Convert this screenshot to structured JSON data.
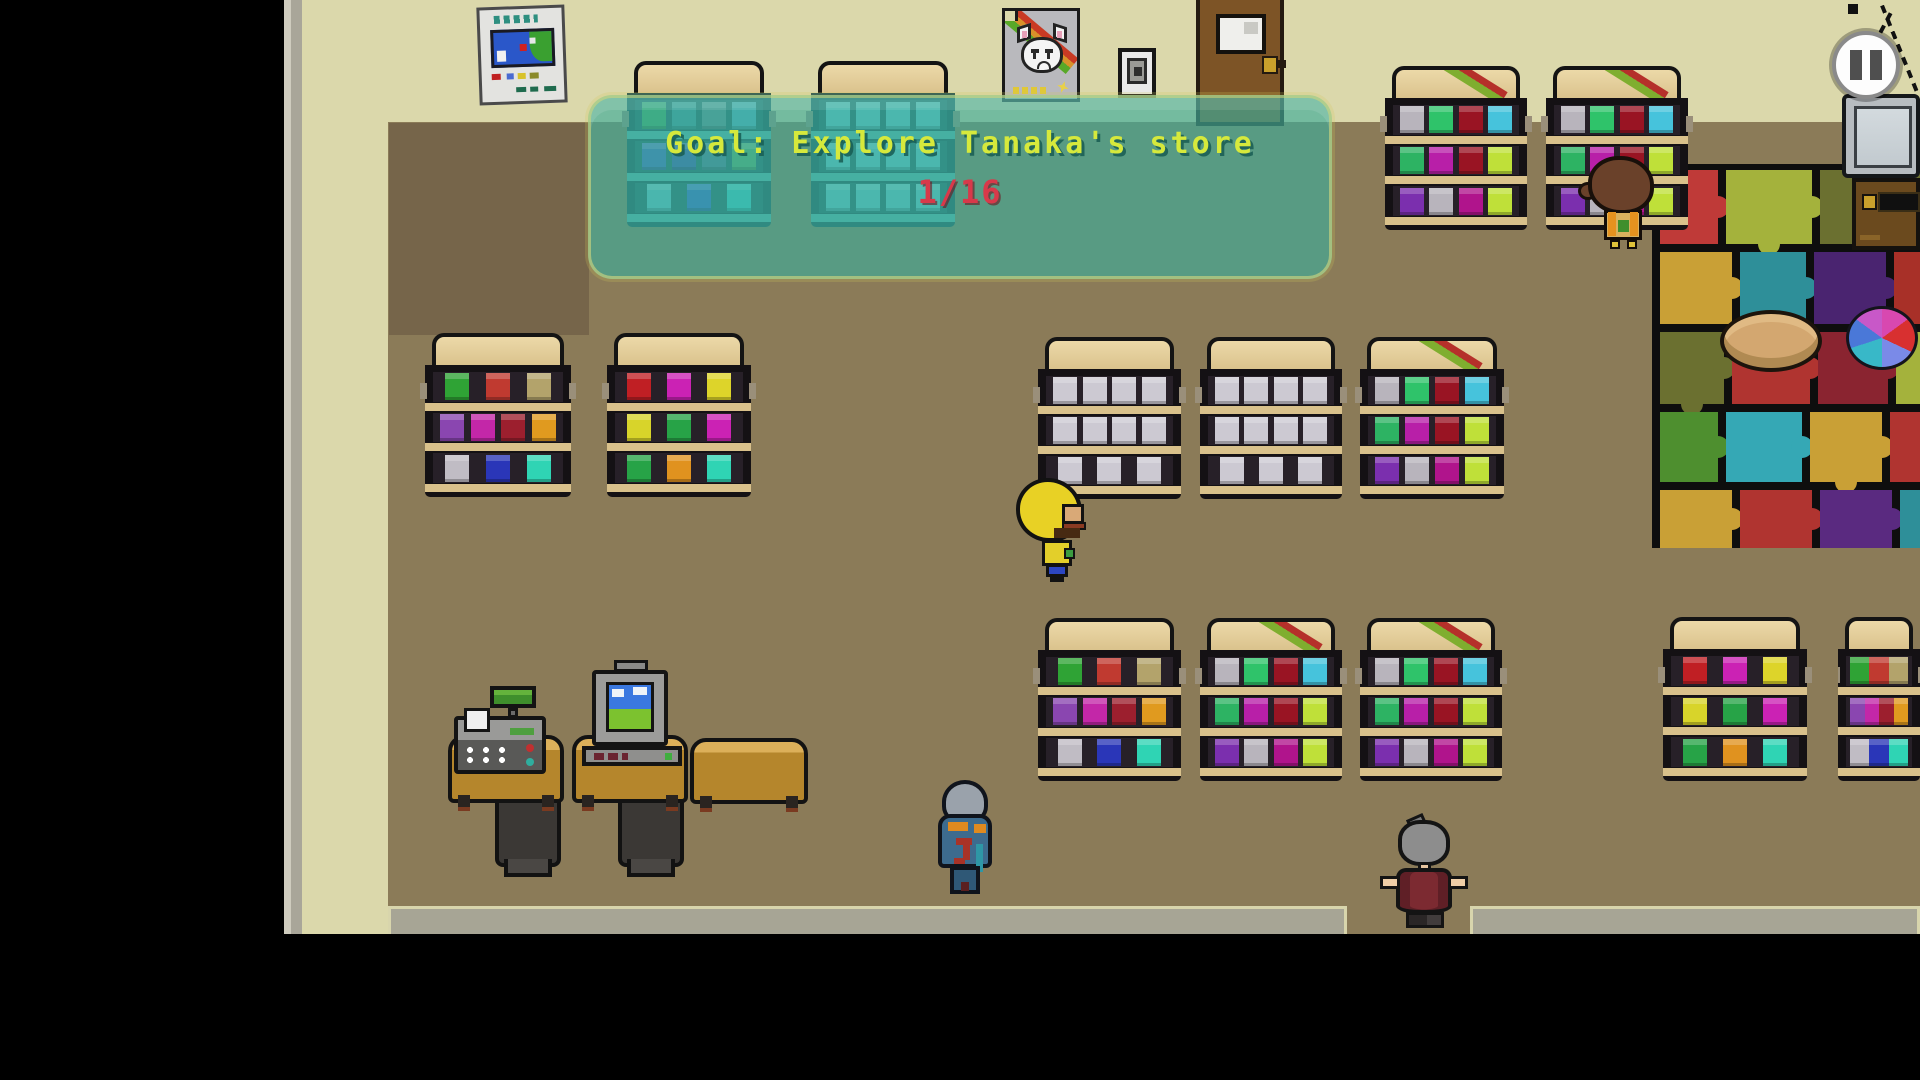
{
  "hud": {
    "goal": {
      "label": "Goal: Explore Tanaka's store",
      "progress": "1/16"
    },
    "pause_icon": "pause-icon"
  },
  "colors": {
    "banner_fill": "rgba(62,172,154,0.66)",
    "goal_text": "#d6e93c",
    "progress_text": "#d8394a",
    "wall": "#dbd8ab",
    "floor": "#8b7b58",
    "mat_base": "#0e0e0e"
  },
  "shelf_variants": {
    "A": {
      "striped": false,
      "tinted": false,
      "rows": [
        [
          "#2fa335",
          "#c03a30",
          "#b3a36b"
        ],
        [
          "#8a46b0",
          "#c327a8",
          "#9c1f2e",
          "#e09a1f"
        ],
        [
          "#c0bcc4",
          "#2a36b8",
          "#2fd4b4"
        ]
      ]
    },
    "B": {
      "striped": false,
      "tinted": false,
      "rows": [
        [
          "#c01f24",
          "#cb22b4",
          "#ddd42a"
        ],
        [
          "#d8d42a",
          "#27a347",
          "#cb22b4"
        ],
        [
          "#27a347",
          "#e0921f",
          "#2fd4b4"
        ]
      ]
    },
    "C": {
      "striped": true,
      "tinted": false,
      "rows": [
        [
          "#b8b4bc",
          "#2fc36a",
          "#991423",
          "#46c3dc"
        ],
        [
          "#2db363",
          "#b81fa8",
          "#991423",
          "#bfe039"
        ],
        [
          "#7b2fae",
          "#b8b4bc",
          "#b0148c",
          "#bfe039"
        ]
      ]
    },
    "D": {
      "striped": false,
      "tinted": false,
      "rows": [
        [
          "#ccc9d2",
          "#ccc9d2",
          "#ccc9d2",
          "#ccc9d2"
        ],
        [
          "#ccc9d2",
          "#ccc9d2",
          "#ccc9d2",
          "#ccc9d2"
        ],
        [
          "#ccc9d2",
          "#ccc9d2",
          "#ccc9d2"
        ]
      ]
    },
    "VEND_A": {
      "striped": false,
      "tinted": true,
      "rows": [
        [
          "#3fae62",
          "#3e99a0",
          "#5d8f96",
          "#4fb3c9"
        ],
        [
          "#3f63c9",
          "#3a51b5",
          "#4a7a99",
          "#57b06b"
        ],
        [
          "#62c9d6",
          "#2f62d9",
          "#35d6d6"
        ]
      ]
    },
    "VEND_B": {
      "striped": false,
      "tinted": true,
      "rows": [
        [
          "#63cdd6",
          "#63cdd6",
          "#63cdd6",
          "#63cdd6"
        ],
        [
          "#63cdd6",
          "#63cdd6",
          "#63cdd6",
          "#63cdd6"
        ],
        [
          "#63cdd6",
          "#63cdd6",
          "#63cdd6",
          "#63cdd6"
        ]
      ]
    }
  },
  "shelves": [
    {
      "x": 627,
      "y": 61,
      "w": 144,
      "h": 166,
      "variant": "VEND_A"
    },
    {
      "x": 811,
      "y": 61,
      "w": 144,
      "h": 166,
      "variant": "VEND_B"
    },
    {
      "x": 1385,
      "y": 66,
      "w": 142,
      "h": 164,
      "variant": "C"
    },
    {
      "x": 1546,
      "y": 66,
      "w": 142,
      "h": 164,
      "variant": "C"
    },
    {
      "x": 425,
      "y": 333,
      "w": 146,
      "h": 164,
      "variant": "A"
    },
    {
      "x": 607,
      "y": 333,
      "w": 144,
      "h": 164,
      "variant": "B"
    },
    {
      "x": 1038,
      "y": 337,
      "w": 143,
      "h": 162,
      "variant": "D"
    },
    {
      "x": 1200,
      "y": 337,
      "w": 142,
      "h": 162,
      "variant": "D"
    },
    {
      "x": 1360,
      "y": 337,
      "w": 144,
      "h": 162,
      "variant": "C"
    },
    {
      "x": 1038,
      "y": 618,
      "w": 143,
      "h": 163,
      "variant": "A"
    },
    {
      "x": 1200,
      "y": 618,
      "w": 142,
      "h": 163,
      "variant": "C"
    },
    {
      "x": 1360,
      "y": 618,
      "w": 142,
      "h": 163,
      "variant": "C"
    },
    {
      "x": 1663,
      "y": 617,
      "w": 144,
      "h": 164,
      "variant": "B"
    },
    {
      "x": 1838,
      "y": 617,
      "w": 82,
      "h": 164,
      "variant": "A",
      "clip": true
    }
  ],
  "mat": {
    "x": 1652,
    "y": 164,
    "w": 268,
    "h": 384,
    "pieces": [
      {
        "x": 8,
        "y": 6,
        "w": 58,
        "h": 74,
        "c": "#bf3a38",
        "tabs": "r"
      },
      {
        "x": 74,
        "y": 6,
        "w": 86,
        "h": 74,
        "c": "#a4b23c",
        "tabs": "rb"
      },
      {
        "x": 168,
        "y": 6,
        "w": 100,
        "h": 74,
        "c": "#6b7030",
        "tabs": ""
      },
      {
        "x": 8,
        "y": 88,
        "w": 72,
        "h": 72,
        "c": "#c9a036",
        "tabs": "r"
      },
      {
        "x": 88,
        "y": 88,
        "w": 66,
        "h": 72,
        "c": "#2e8f99",
        "tabs": "rb"
      },
      {
        "x": 162,
        "y": 88,
        "w": 72,
        "h": 72,
        "c": "#4a2470",
        "tabs": "r"
      },
      {
        "x": 242,
        "y": 88,
        "w": 26,
        "h": 72,
        "c": "#a83028",
        "tabs": ""
      },
      {
        "x": 8,
        "y": 168,
        "w": 64,
        "h": 72,
        "c": "#6b7030",
        "tabs": "rb"
      },
      {
        "x": 80,
        "y": 168,
        "w": 78,
        "h": 72,
        "c": "#b03430",
        "tabs": "r"
      },
      {
        "x": 166,
        "y": 168,
        "w": 70,
        "h": 72,
        "c": "#8a2430",
        "tabs": "r"
      },
      {
        "x": 244,
        "y": 168,
        "w": 24,
        "h": 72,
        "c": "#a4b23c",
        "tabs": ""
      },
      {
        "x": 8,
        "y": 248,
        "w": 58,
        "h": 70,
        "c": "#4e8f2f",
        "tabs": "r"
      },
      {
        "x": 74,
        "y": 248,
        "w": 76,
        "h": 70,
        "c": "#35a8b5",
        "tabs": "r"
      },
      {
        "x": 158,
        "y": 248,
        "w": 72,
        "h": 70,
        "c": "#c9a036",
        "tabs": "rb"
      },
      {
        "x": 238,
        "y": 248,
        "w": 30,
        "h": 70,
        "c": "#b03430",
        "tabs": ""
      },
      {
        "x": 8,
        "y": 326,
        "w": 72,
        "h": 58,
        "c": "#c9a036",
        "tabs": "r"
      },
      {
        "x": 88,
        "y": 326,
        "w": 72,
        "h": 58,
        "c": "#b03430",
        "tabs": "r"
      },
      {
        "x": 168,
        "y": 326,
        "w": 72,
        "h": 58,
        "c": "#5a2a80",
        "tabs": "r"
      },
      {
        "x": 248,
        "y": 326,
        "w": 20,
        "h": 58,
        "c": "#2e8f99",
        "tabs": ""
      }
    ]
  },
  "sprites": [
    {
      "name": "player-blonde"
    },
    {
      "name": "npc-blue-hood"
    },
    {
      "name": "npc-gray-haired-lady"
    },
    {
      "name": "npc-brown-haired-kid"
    }
  ]
}
